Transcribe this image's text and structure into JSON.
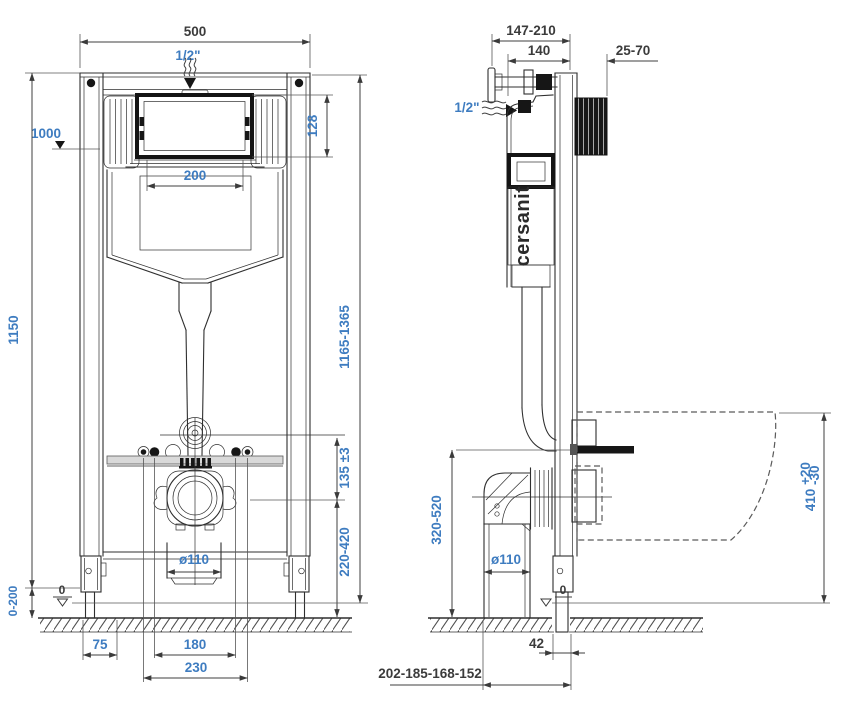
{
  "drawing": {
    "brand": "cersanit",
    "front": {
      "total_width": "500",
      "inlet": "1/2\"",
      "height_marker": "1000",
      "plate_opening_height": "128",
      "plate_opening_width": "200",
      "frame_height": "1150",
      "install_height_range": "1165-1365",
      "flush_offset": "135 ±3",
      "flush_outlet_height": "220-420",
      "drain_diameter": "ø110",
      "floor_zero": "0",
      "leg_adjust_range": "0-200",
      "foot_width": "75",
      "fixing_spacing": "180",
      "outer_fixing_spacing": "230"
    },
    "side": {
      "depth_range": "147-210",
      "frame_depth": "140",
      "wall_offset_range": "25-70",
      "inlet": "1/2\"",
      "outlet_height_range": "320-520",
      "drain_diameter": "ø110",
      "bowl_top_height": "410",
      "bowl_tol_upper": "+20",
      "bowl_tol_lower": "-30",
      "floor_zero": "0",
      "foot_depth": "42",
      "outlet_distance_range": "202-185-168-152"
    }
  }
}
